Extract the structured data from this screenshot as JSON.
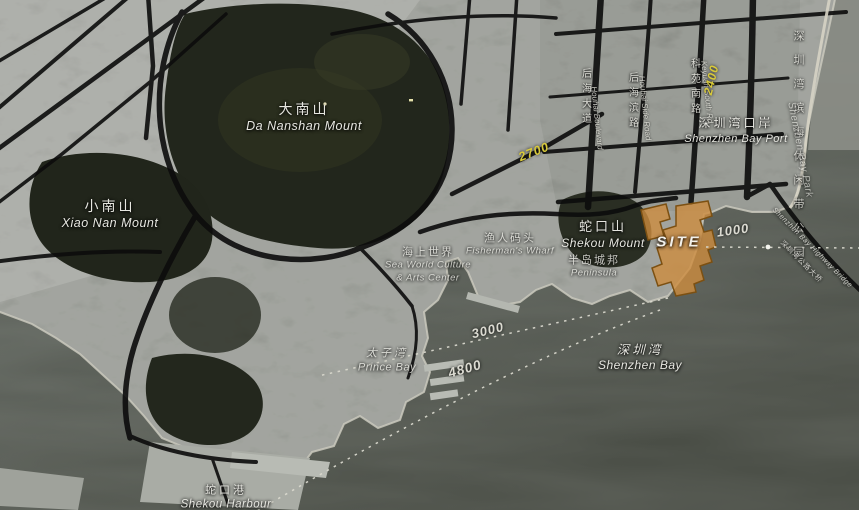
{
  "map": {
    "site": {
      "label": "SITE"
    },
    "places": [
      {
        "id": "da-nanshan",
        "zh": "大南山",
        "en": "Da Nanshan Mount"
      },
      {
        "id": "xiao-nan",
        "zh": "小南山",
        "en": "Xiao Nan Mount"
      },
      {
        "id": "shekou-mount",
        "zh": "蛇口山",
        "en": "Shekou Mount"
      },
      {
        "id": "fishermans-wharf",
        "zh": "渔人码头",
        "en": "Fisherman's Wharf"
      },
      {
        "id": "sea-world",
        "zh": "海上世界",
        "en": "Sea World Culture",
        "en2": "& Arts Center"
      },
      {
        "id": "peninsula",
        "zh": "半岛城邦",
        "en": "Peninsula"
      },
      {
        "id": "shenzhen-bay-port",
        "zh": "深圳湾口岸",
        "en": "Shenzhen Bay Port"
      },
      {
        "id": "shenzhen-bay",
        "zh": "深圳湾",
        "en": "Shenzhen Bay"
      },
      {
        "id": "prince-bay",
        "zh": "太子湾",
        "en": "Prince Bay"
      },
      {
        "id": "shekou-harbour",
        "zh": "蛇口港",
        "en": "Shekou Harbour"
      },
      {
        "id": "shenzhen-bay-park",
        "zh": "深圳湾滨海休闲带公园",
        "en": "Shenzhen Bay Park"
      },
      {
        "id": "highway-bridge",
        "zh": "深圳湾公路大桥",
        "en": "Shenzhen Bay Highway Bridge"
      }
    ],
    "roads": [
      {
        "id": "houhai-boulevard",
        "zh": "后海大道",
        "en": "Houhai Boulevard"
      },
      {
        "id": "houhai-side-road",
        "zh": "后海滨路",
        "en": "Houhai Side Road"
      },
      {
        "id": "keyuan-south-rd",
        "zh": "科苑南路",
        "en": "Keyuan South Rd"
      }
    ],
    "distances": {
      "d1000": "1000",
      "d2400": "2400",
      "d2700": "2700",
      "d3000": "3000",
      "d4800": "4800"
    },
    "colors": {
      "site_fill": "#cd8c3e",
      "site_stroke": "#7c5012",
      "distance_yellow": "#d8c93a",
      "label_white": "#e6e6e0",
      "water": "#565b55",
      "road_black": "#0c0c0c"
    }
  }
}
